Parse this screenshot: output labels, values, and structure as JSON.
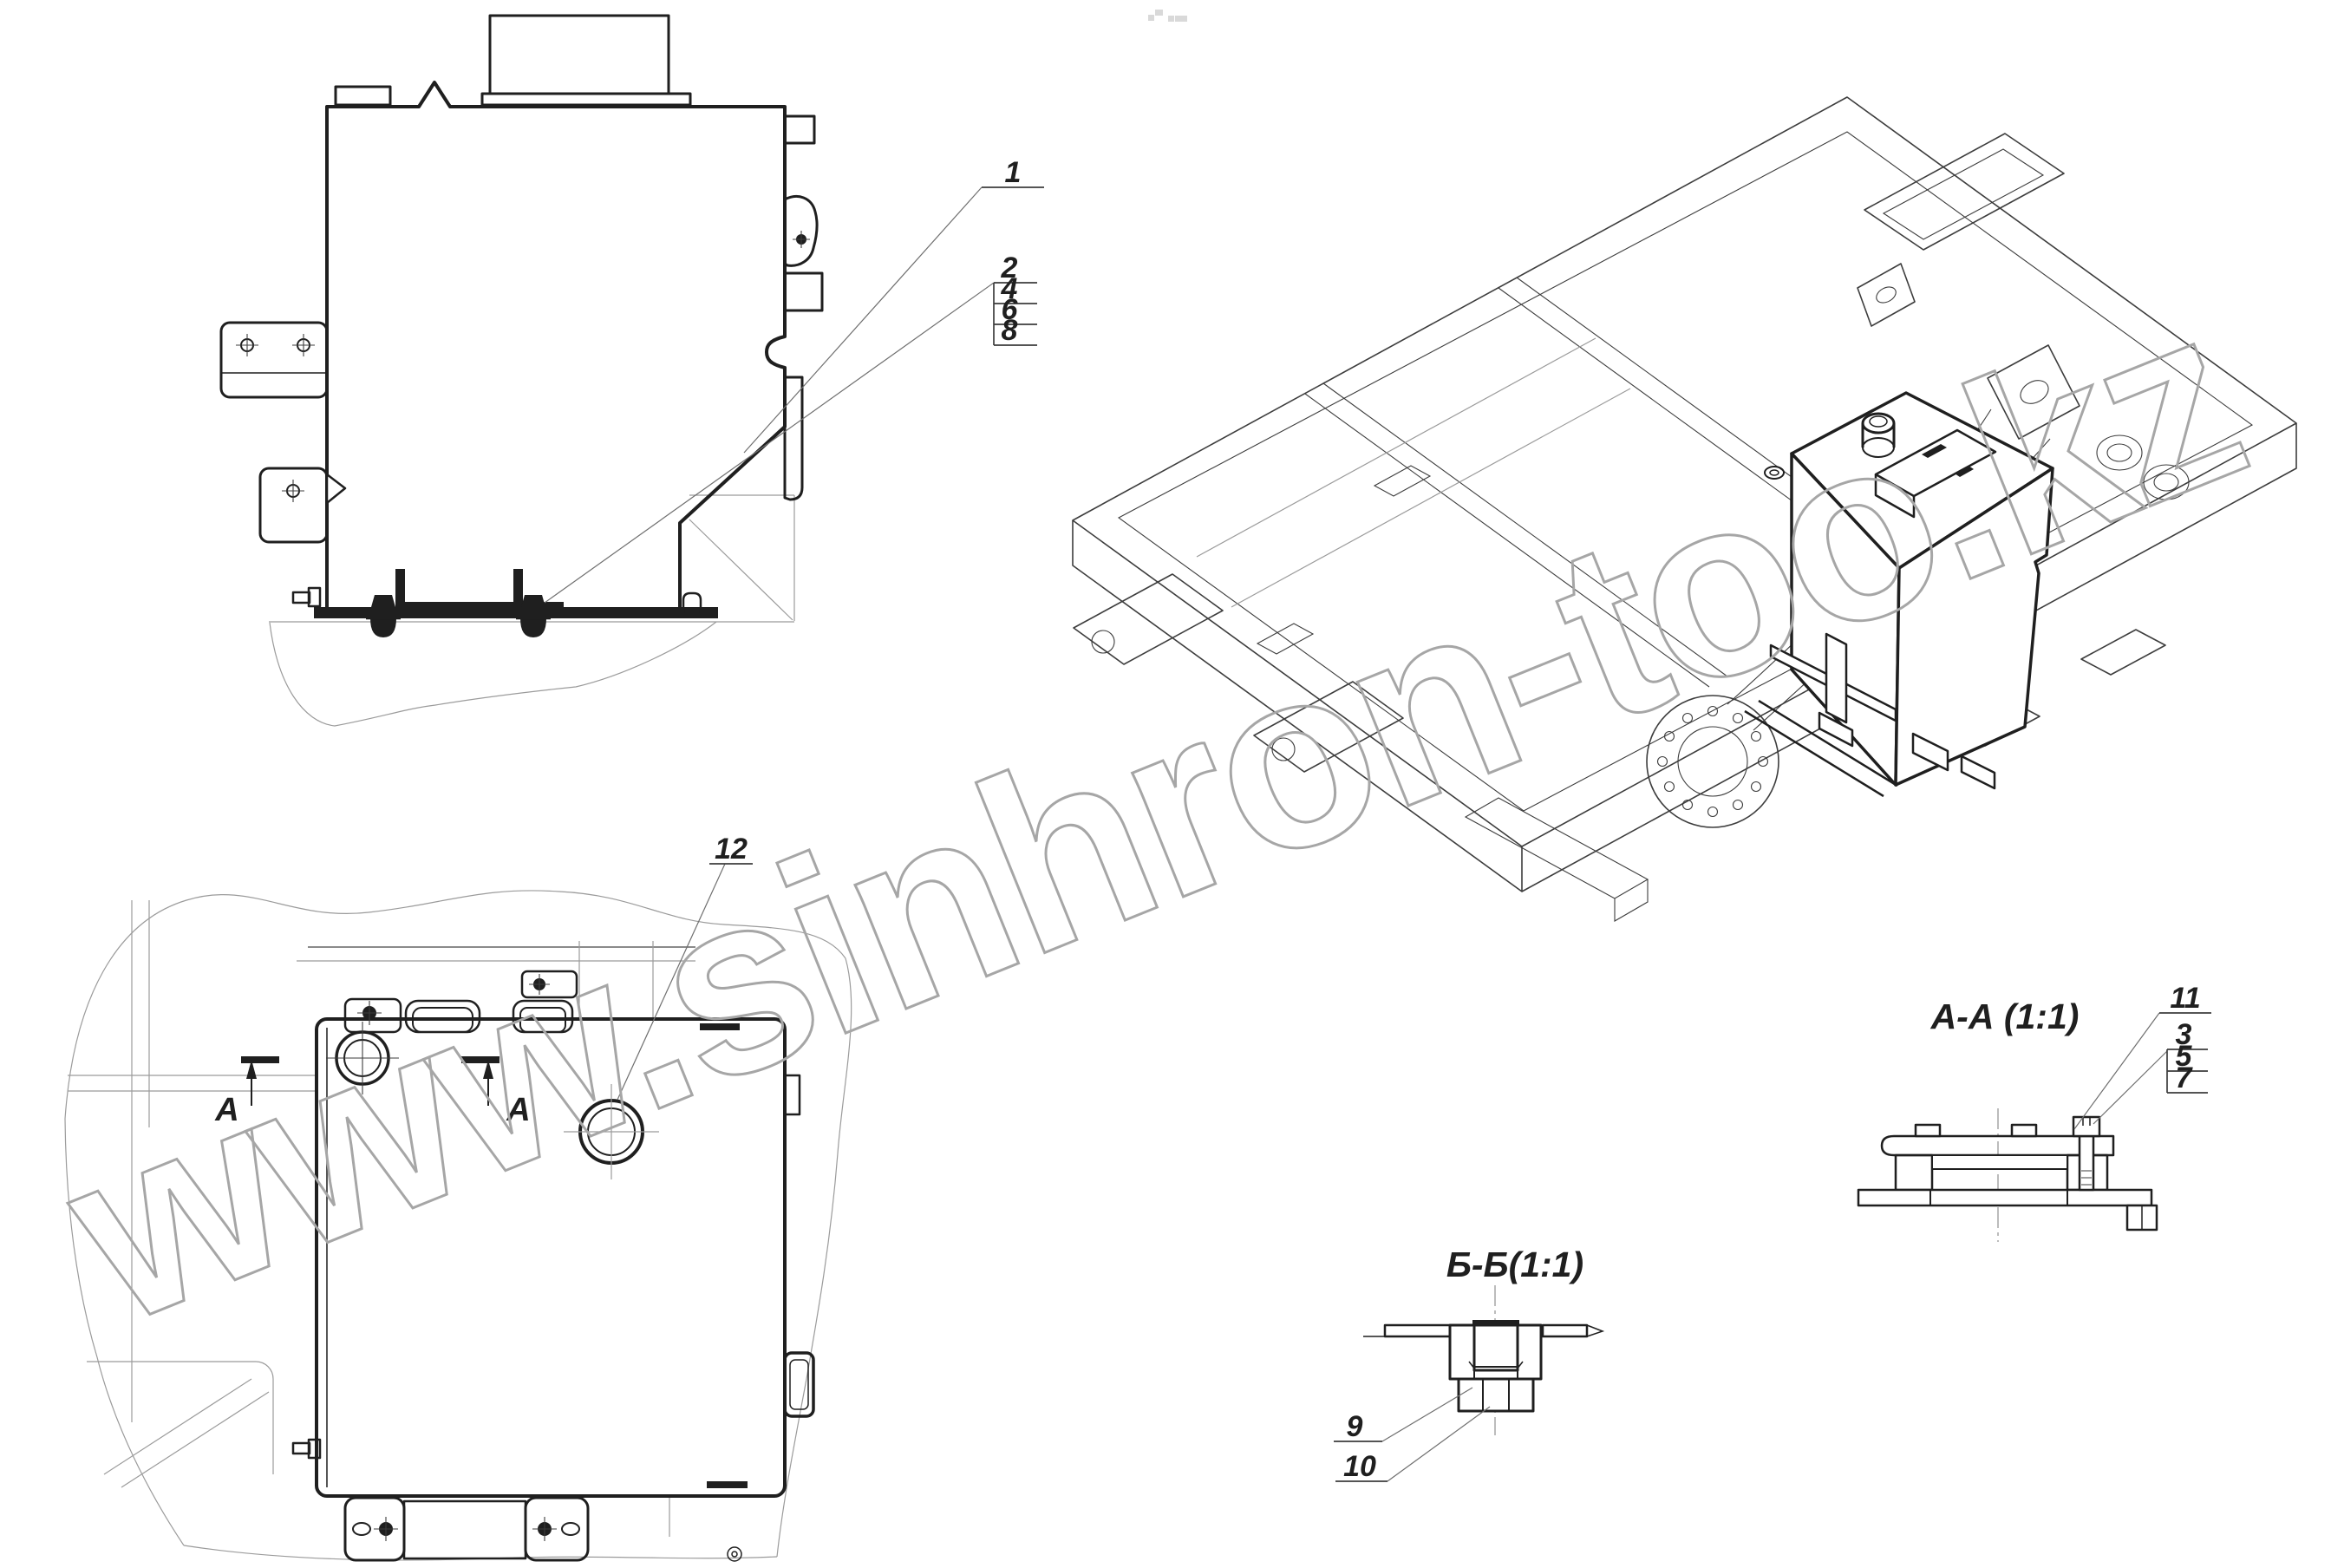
{
  "colors": {
    "background": "#ffffff",
    "line_main": "#1f1f1f",
    "line_medium": "#3d3d3d",
    "line_light": "#9b9b9b",
    "leader": "#6f6f6f",
    "watermark": "#a6a6a6",
    "hatch": "#4a4a4a"
  },
  "watermark": {
    "text": "www.sinhron-too.kz"
  },
  "side_view": {
    "callout_main": "1",
    "callout_stack": [
      "2",
      "4",
      "6",
      "8"
    ]
  },
  "top_view": {
    "callout_filler": "12",
    "section_letter_left": "А",
    "section_letter_right": "А"
  },
  "section_aa": {
    "title": "А-А  (1:1)",
    "callout_top": "11",
    "callout_stack": [
      "3",
      "5",
      "7"
    ]
  },
  "section_bb": {
    "title": "Б-Б(1:1)",
    "callout_upper": "9",
    "callout_lower": "10"
  }
}
